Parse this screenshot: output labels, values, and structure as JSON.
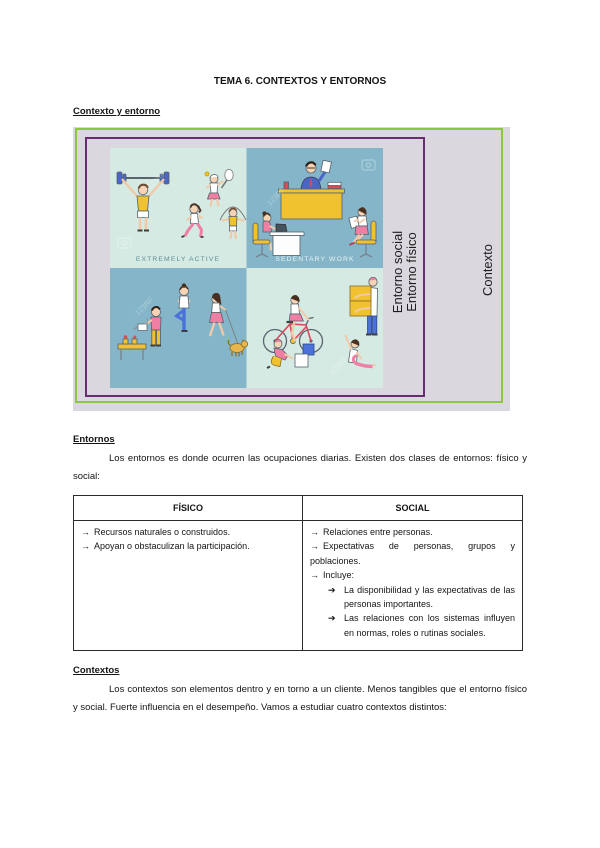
{
  "page": {
    "title": "TEMA 6. CONTEXTOS Y ENTORNOS"
  },
  "headings": {
    "contexto_entorno": "Contexto y entorno",
    "entornos": "Entornos",
    "contextos": "Contextos"
  },
  "paragraphs": {
    "entornos": "Los entornos es donde ocurren las ocupaciones diarias. Existen dos clases de entornos: físico y social:",
    "contextos": "Los contextos son elementos dentro y en torno a un cliente. Menos tangibles que el entorno físico y social. Fuerte influencia en el desempeño. Vamos a estudiar cuatro contextos distintos:"
  },
  "figure": {
    "vertical_labels": {
      "line1": "Entorno social",
      "line2": "Entorno físico",
      "outer": "Contexto"
    },
    "captions": {
      "active": "EXTREMELY ACTIVE",
      "sedentary": "SEDENTARY WORK"
    },
    "watermark": "123RF",
    "colors": {
      "block_bg": "#dbd7de",
      "green_border": "#8dc63f",
      "purple_border": "#682c70",
      "quad_light": "#d6eae4",
      "quad_blue": "#84b5c9"
    }
  },
  "table": {
    "headers": [
      "FÍSICO",
      "SOCIAL"
    ],
    "arrow": "→",
    "sub_arrow": "➔",
    "fisico": [
      "Recursos naturales o construidos.",
      "Apoyan o obstaculizan la participación."
    ],
    "social": [
      "Relaciones entre personas.",
      "Expectativas de personas, grupos y poblaciones.",
      "Incluye:"
    ],
    "social_sub": [
      "La disponibilidad y las expectativas de las personas importantes.",
      "Las relaciones con los sistemas influyen en normas, roles o rutinas sociales."
    ]
  }
}
